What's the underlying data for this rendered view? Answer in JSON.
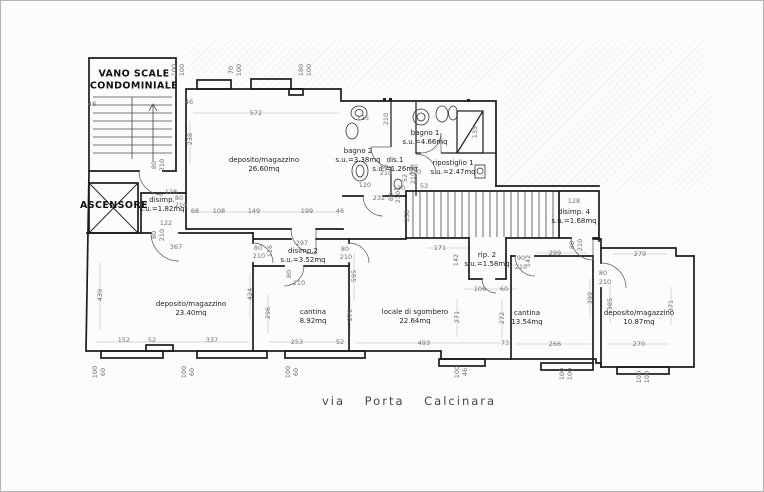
{
  "street_label": "via Porta Calcinara",
  "rooms": [
    {
      "line1": "VANO SCALE",
      "line2": "CONDOMINIALE"
    },
    {
      "line1": "ASCENSORE",
      "line2": ""
    },
    {
      "line1": "deposito/magazzino",
      "line2": "26.60mq"
    },
    {
      "line1": "bagno 2",
      "line2": "s.u.=3.38mq"
    },
    {
      "line1": "dis.1",
      "line2": "s.u.=1.26mq"
    },
    {
      "line1": "bagno 1",
      "line2": "s.u.=4.66mq"
    },
    {
      "line1": "ripostiglio 1",
      "line2": "s.u.=2.47mq"
    },
    {
      "line1": "disimp.",
      "line2": "s.u.=1.82mq"
    },
    {
      "line1": "disimp. 4",
      "line2": "s.u.=1.68mq"
    },
    {
      "line1": "rip. 2",
      "line2": "s.u.=1.58mq"
    },
    {
      "line1": "disimp.2",
      "line2": "s.u.=3.52mq"
    },
    {
      "line1": "deposito/magazzino",
      "line2": "23.40mq"
    },
    {
      "line1": "cantina",
      "line2": "8.92mq"
    },
    {
      "line1": "locale di sgombero",
      "line2": "22.64mq"
    },
    {
      "line1": "cantina",
      "line2": "13.54mq"
    },
    {
      "line1": "deposito/magazzino",
      "line2": "10.87mq"
    }
  ],
  "colors": {
    "wall": "#1c1c1c",
    "dimension_text": "#707070",
    "room_text": "#1f1f1f",
    "paper": "#fcfcfc"
  },
  "dimensions": [
    {
      "t": "100",
      "x": 173,
      "y": 69,
      "r": 1
    },
    {
      "t": "100",
      "x": 181,
      "y": 69,
      "r": 1
    },
    {
      "t": "70",
      "x": 230,
      "y": 69,
      "r": 1
    },
    {
      "t": "100",
      "x": 238,
      "y": 69,
      "r": 1
    },
    {
      "t": "180",
      "x": 300,
      "y": 69,
      "r": 1
    },
    {
      "t": "100",
      "x": 308,
      "y": 69,
      "r": 1
    },
    {
      "t": "48",
      "x": 91,
      "y": 103
    },
    {
      "t": "128",
      "x": 170,
      "y": 191
    },
    {
      "t": "80",
      "x": 178,
      "y": 197
    },
    {
      "t": "210",
      "x": 180,
      "y": 204
    },
    {
      "t": "122",
      "x": 165,
      "y": 222
    },
    {
      "t": "80",
      "x": 153,
      "y": 234,
      "r": 1
    },
    {
      "t": "210",
      "x": 161,
      "y": 234,
      "r": 1
    },
    {
      "t": "367",
      "x": 175,
      "y": 246
    },
    {
      "t": "80",
      "x": 153,
      "y": 164,
      "r": 1
    },
    {
      "t": "210",
      "x": 161,
      "y": 164,
      "r": 1
    },
    {
      "t": "46",
      "x": 188,
      "y": 101
    },
    {
      "t": "572",
      "x": 255,
      "y": 112
    },
    {
      "t": "238",
      "x": 189,
      "y": 138,
      "r": 1
    },
    {
      "t": "68",
      "x": 194,
      "y": 210
    },
    {
      "t": "108",
      "x": 218,
      "y": 210
    },
    {
      "t": "149",
      "x": 253,
      "y": 210
    },
    {
      "t": "199",
      "x": 306,
      "y": 210
    },
    {
      "t": "46",
      "x": 339,
      "y": 210
    },
    {
      "t": "125",
      "x": 362,
      "y": 117
    },
    {
      "t": "210",
      "x": 385,
      "y": 118,
      "r": 1
    },
    {
      "t": "80",
      "x": 383,
      "y": 166
    },
    {
      "t": "210",
      "x": 385,
      "y": 172
    },
    {
      "t": "80",
      "x": 413,
      "y": 166
    },
    {
      "t": "210",
      "x": 414,
      "y": 171
    },
    {
      "t": "52",
      "x": 404,
      "y": 177,
      "r": 1
    },
    {
      "t": "210",
      "x": 412,
      "y": 177,
      "r": 1
    },
    {
      "t": "120",
      "x": 364,
      "y": 184
    },
    {
      "t": "232",
      "x": 378,
      "y": 197
    },
    {
      "t": "130",
      "x": 398,
      "y": 187
    },
    {
      "t": "80",
      "x": 390,
      "y": 196,
      "r": 1
    },
    {
      "t": "210",
      "x": 397,
      "y": 196,
      "r": 1
    },
    {
      "t": "53",
      "x": 423,
      "y": 185
    },
    {
      "t": "135",
      "x": 474,
      "y": 131,
      "r": 1
    },
    {
      "t": "128",
      "x": 573,
      "y": 200
    },
    {
      "t": "158",
      "x": 406,
      "y": 215,
      "r": 1
    },
    {
      "t": "171",
      "x": 439,
      "y": 247
    },
    {
      "t": "142",
      "x": 455,
      "y": 259,
      "r": 1
    },
    {
      "t": "142",
      "x": 527,
      "y": 260,
      "r": 1
    },
    {
      "t": "90",
      "x": 520,
      "y": 257
    },
    {
      "t": "210",
      "x": 520,
      "y": 266
    },
    {
      "t": "299",
      "x": 554,
      "y": 252
    },
    {
      "t": "106",
      "x": 479,
      "y": 288
    },
    {
      "t": "60",
      "x": 503,
      "y": 288
    },
    {
      "t": "80",
      "x": 571,
      "y": 244,
      "r": 1
    },
    {
      "t": "210",
      "x": 579,
      "y": 244,
      "r": 1
    },
    {
      "t": "297",
      "x": 301,
      "y": 242
    },
    {
      "t": "116",
      "x": 269,
      "y": 250,
      "r": 1
    },
    {
      "t": "80",
      "x": 257,
      "y": 247
    },
    {
      "t": "210",
      "x": 258,
      "y": 255
    },
    {
      "t": "80",
      "x": 344,
      "y": 248
    },
    {
      "t": "210",
      "x": 345,
      "y": 256
    },
    {
      "t": "80",
      "x": 288,
      "y": 273,
      "r": 1
    },
    {
      "t": "210",
      "x": 298,
      "y": 282
    },
    {
      "t": "424",
      "x": 249,
      "y": 293,
      "r": 1
    },
    {
      "t": "296",
      "x": 267,
      "y": 312,
      "r": 1
    },
    {
      "t": "279",
      "x": 349,
      "y": 314,
      "r": 1
    },
    {
      "t": "595",
      "x": 353,
      "y": 275,
      "r": 1
    },
    {
      "t": "253",
      "x": 296,
      "y": 341
    },
    {
      "t": "52",
      "x": 339,
      "y": 341
    },
    {
      "t": "152",
      "x": 123,
      "y": 339
    },
    {
      "t": "52",
      "x": 151,
      "y": 339
    },
    {
      "t": "337",
      "x": 211,
      "y": 339
    },
    {
      "t": "439",
      "x": 99,
      "y": 294,
      "r": 1
    },
    {
      "t": "271",
      "x": 456,
      "y": 316,
      "r": 1
    },
    {
      "t": "272",
      "x": 501,
      "y": 317,
      "r": 1
    },
    {
      "t": "493",
      "x": 423,
      "y": 342
    },
    {
      "t": "73",
      "x": 504,
      "y": 342
    },
    {
      "t": "266",
      "x": 554,
      "y": 343
    },
    {
      "t": "270",
      "x": 638,
      "y": 343
    },
    {
      "t": "279",
      "x": 639,
      "y": 253
    },
    {
      "t": "80",
      "x": 602,
      "y": 272
    },
    {
      "t": "210",
      "x": 604,
      "y": 281
    },
    {
      "t": "399",
      "x": 589,
      "y": 297,
      "r": 1
    },
    {
      "t": "385",
      "x": 609,
      "y": 303,
      "r": 1
    },
    {
      "t": "371",
      "x": 670,
      "y": 305,
      "r": 1
    },
    {
      "t": "100",
      "x": 94,
      "y": 371,
      "r": 1
    },
    {
      "t": "60",
      "x": 102,
      "y": 371,
      "r": 1
    },
    {
      "t": "100",
      "x": 183,
      "y": 371,
      "r": 1
    },
    {
      "t": "60",
      "x": 191,
      "y": 371,
      "r": 1
    },
    {
      "t": "100",
      "x": 287,
      "y": 371,
      "r": 1
    },
    {
      "t": "60",
      "x": 295,
      "y": 371,
      "r": 1
    },
    {
      "t": "100",
      "x": 456,
      "y": 371,
      "r": 1
    },
    {
      "t": "46",
      "x": 464,
      "y": 371,
      "r": 1
    },
    {
      "t": "100",
      "x": 561,
      "y": 373,
      "r": 1
    },
    {
      "t": "100",
      "x": 569,
      "y": 373,
      "r": 1
    },
    {
      "t": "100",
      "x": 638,
      "y": 376,
      "r": 1
    },
    {
      "t": "100",
      "x": 646,
      "y": 376,
      "r": 1
    }
  ]
}
